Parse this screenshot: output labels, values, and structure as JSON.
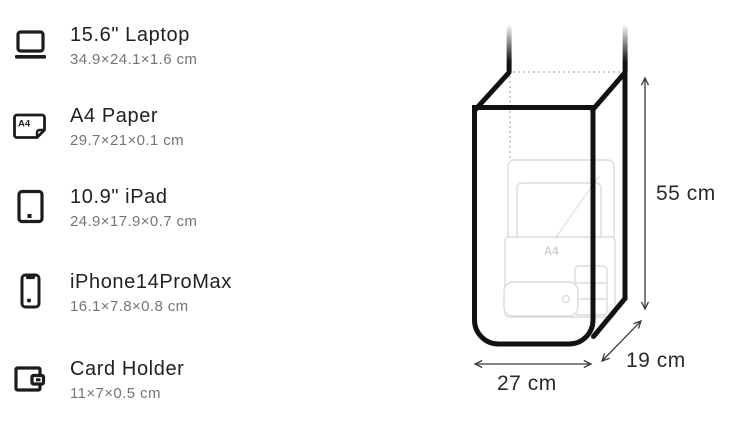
{
  "page": {
    "background": "#ffffff",
    "accent_outline": "#111111",
    "faint_item_outline": "#dcdcdc",
    "dotted_hidden_edge": "#bdbdbd"
  },
  "item_list": {
    "items": [
      {
        "icon": "laptop-icon",
        "title": "15.6\" Laptop",
        "dimensions": "34.9×24.1×1.6 cm"
      },
      {
        "icon": "a4-paper-icon",
        "title": "A4 Paper",
        "dimensions": "29.7×21×0.1 cm"
      },
      {
        "icon": "ipad-icon",
        "title": "10.9\" iPad",
        "dimensions": "24.9×17.9×0.7 cm"
      },
      {
        "icon": "iphone-icon",
        "title": "iPhone14ProMax",
        "dimensions": "16.1×7.8×0.8 cm"
      },
      {
        "icon": "card-holder-icon",
        "title": "Card Holder",
        "dimensions": "11×7×0.5 cm"
      }
    ],
    "a4_icon_text": "A4"
  },
  "bag_diagram": {
    "height_label": "55 cm",
    "depth_label": "19 cm",
    "width_label": "27 cm",
    "a4_watermark": "A4"
  }
}
